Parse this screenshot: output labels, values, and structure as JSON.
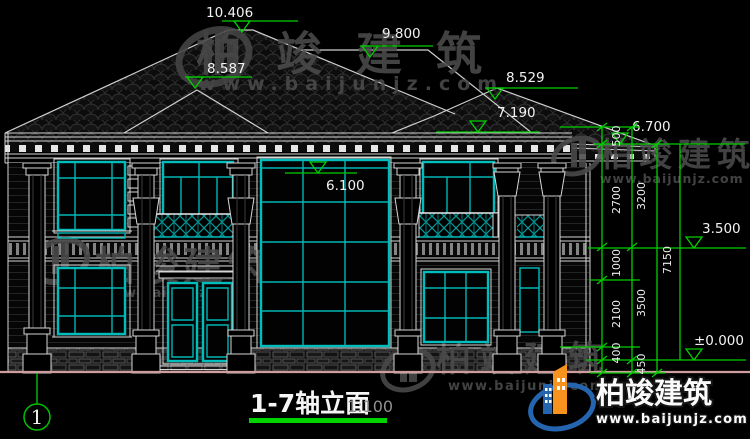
{
  "drawing": {
    "title": "1-7轴立面",
    "scale_label": "1:100",
    "axis_bubble": "1",
    "elevations": {
      "main_ridge": "10.406",
      "secondary_ridge": "9.800",
      "left_hip": "8.587",
      "right_hip": "8.529",
      "main_eave": "7.190",
      "low_eave": "6.700",
      "window_head": "6.100",
      "second_floor": "3.500",
      "ground": "±0.000"
    },
    "chain": {
      "c500": "500",
      "c2700": "2700",
      "c1000": "1000",
      "c2100": "2100",
      "c400": "400",
      "c3200": "3200",
      "c3500": "3500",
      "c450": "450",
      "c7150": "7150"
    }
  },
  "watermark": {
    "brand": "柏竣建筑",
    "url": "www.baijunjz.com"
  },
  "logo": {
    "brand": "柏竣建筑",
    "url": "www.baijunjz.com"
  },
  "colors": {
    "window_teal": "#00b6b6",
    "dimension_green": "#00cf00",
    "ground_pink": "#cf9d9d",
    "underline_green": "#00d400",
    "logo_orange": "#f6921e",
    "logo_blue": "#2565b0"
  }
}
